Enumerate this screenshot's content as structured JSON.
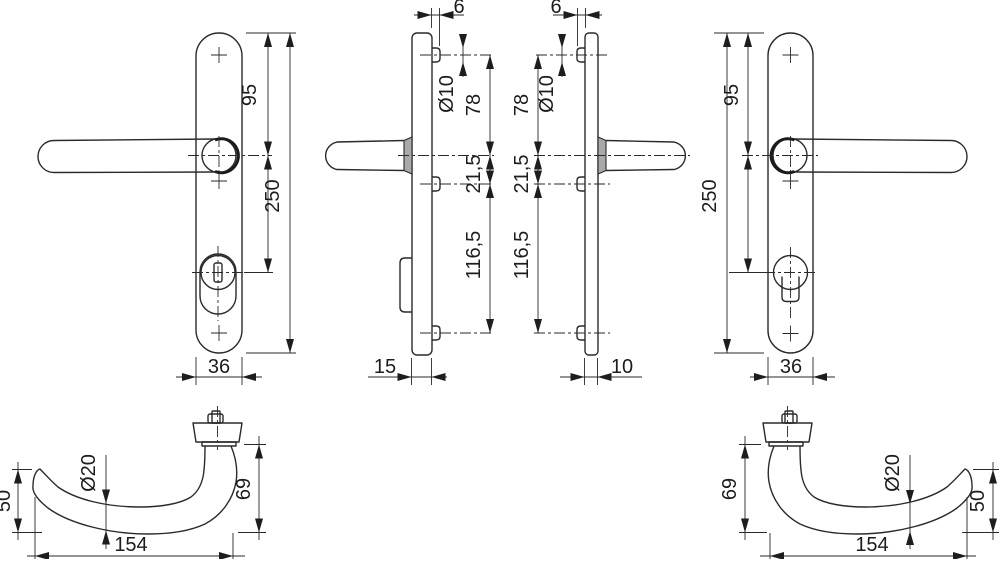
{
  "drawing": {
    "front_left": {
      "top_to_handle": "95",
      "total_height": "250",
      "plate_width": "36"
    },
    "side_left": {
      "clip_protrusion": "6",
      "clip_diameter": "Ø10",
      "top_clip_to_handle": "78",
      "handle_to_mid_clip": "21,5",
      "mid_to_bottom_clip": "116,5",
      "plate_depth": "15"
    },
    "side_right": {
      "clip_protrusion": "6",
      "clip_diameter": "Ø10",
      "top_clip_to_handle": "78",
      "handle_to_mid_clip": "21,5",
      "mid_to_bottom_clip": "116,5",
      "plate_depth": "10"
    },
    "front_right": {
      "top_to_handle": "95",
      "total_height": "250",
      "plate_width": "36"
    },
    "grip_left": {
      "grip_drop": "50",
      "grip_diameter": "Ø20",
      "grip_length": "154",
      "neck_height": "69"
    },
    "grip_right": {
      "grip_drop": "50",
      "grip_diameter": "Ø20",
      "grip_length": "154",
      "neck_height": "69"
    }
  },
  "colors": {
    "line": "#2a2a2a",
    "background": "#ffffff",
    "section_fill": "#a9a9a9"
  }
}
